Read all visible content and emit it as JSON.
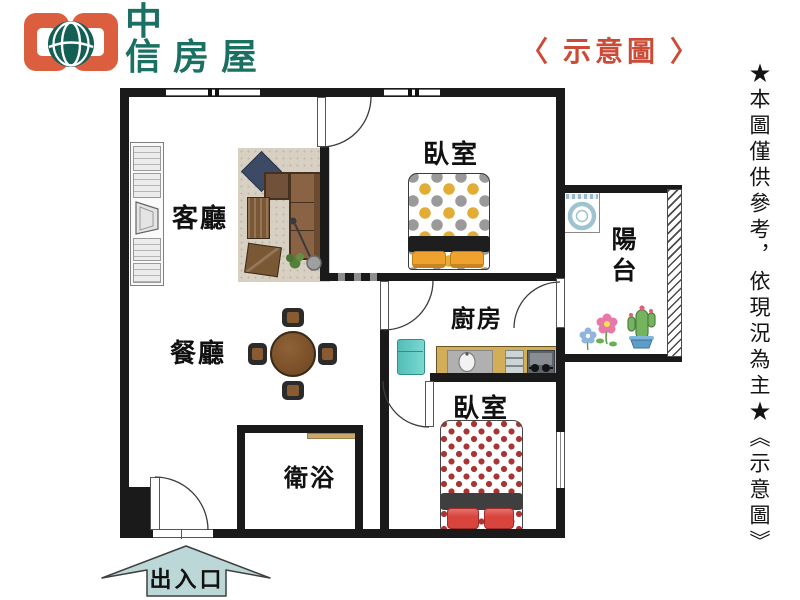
{
  "header": {
    "logo_line1": "中",
    "logo_line2": "信房屋",
    "title": "〈 示意圖 〉"
  },
  "disclaimer_vertical": "★本圖僅供參考，依現況為主★《示意圖》",
  "rooms": {
    "living_room": "客廳",
    "dining_room": "餐廳",
    "kitchen": "廚房",
    "bedroom_top": "臥室",
    "bedroom_bottom": "臥室",
    "bathroom": "衛浴",
    "balcony": "陽台"
  },
  "entrance": {
    "label": "出入口"
  },
  "colors": {
    "wall": "#1a1a1a",
    "title_red": "#cb4b37",
    "logo_green": "#1b7164",
    "logo_orange": "#db5f3e",
    "arrow_fill": "#bcd7d8",
    "bed1_dot_yellow": "#e3ac35",
    "bed1_dot_gray": "#9a9a9a",
    "bed1_pillow": "#f0a22e",
    "bed2_star_red": "#a83434",
    "bed2_pillow": "#d9453c",
    "fridge_teal": "#62c9c3",
    "counter_tan": "#d2ae58",
    "sofa_brown": "#8a6244",
    "table_brown": "#7b4f28",
    "rug_beige": "#d8d0c3"
  }
}
